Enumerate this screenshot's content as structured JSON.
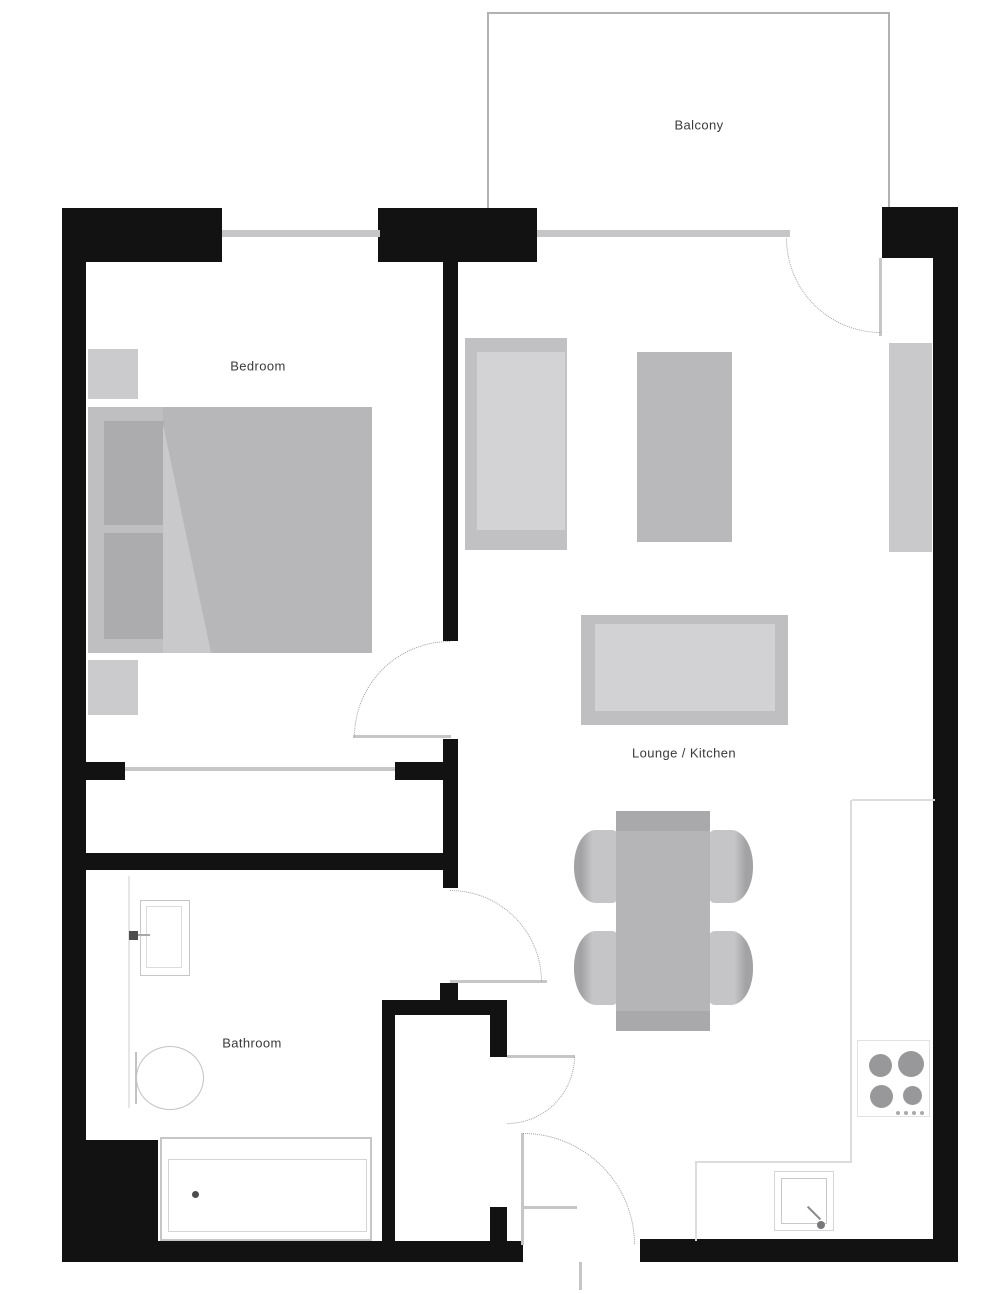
{
  "rooms": [
    {
      "name": "balcony",
      "label": "Balcony"
    },
    {
      "name": "bedroom",
      "label": "Bedroom"
    },
    {
      "name": "lounge-kitchen",
      "label": "Lounge / Kitchen"
    },
    {
      "name": "bathroom",
      "label": "Bathroom"
    }
  ],
  "fixtures": [
    "bed",
    "pillow",
    "nightstand",
    "wardrobe-front",
    "sofa",
    "rug",
    "tv-unit",
    "wall-unit",
    "dining-table",
    "chair",
    "kitchen-counter",
    "hob",
    "kitchen-sink",
    "bathtub",
    "toilet",
    "basin",
    "door-swing-arc",
    "window",
    "door-leaf"
  ],
  "colors": {
    "bg": "#ffffff",
    "wall": "#121212",
    "window": "#c6c6c8",
    "leaf": "#c6c6c8",
    "arc": "#9c9c9c",
    "outline": "#b2b2b4",
    "counter": "#dcdcdc",
    "fixture-border": "#c6c6c8",
    "fixture-border-light": "#d6d6d8",
    "furn-dark": "#acacae",
    "furn-mid": "#b7b7b9",
    "furn-light": "#cbcbcd",
    "burner": "#98989a",
    "faint": "#e6e6e6",
    "label": "#3a3a3a"
  }
}
